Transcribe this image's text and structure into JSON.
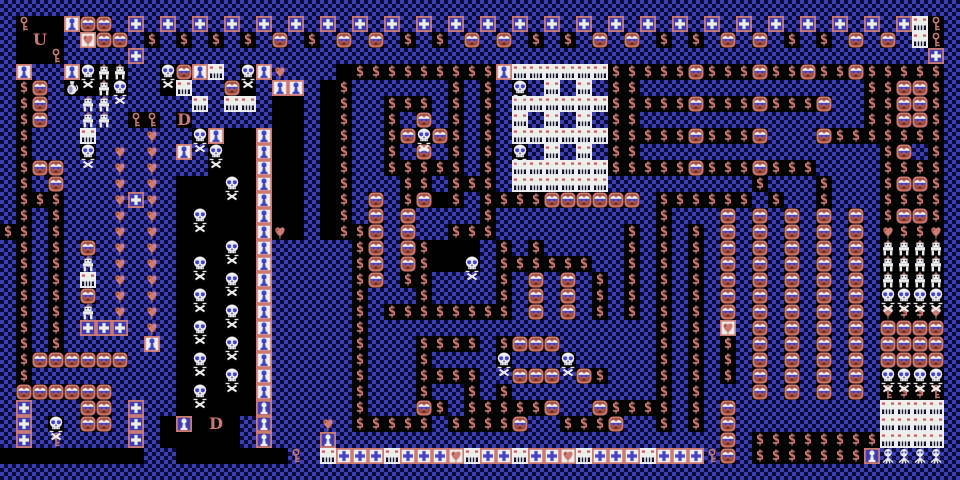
{
  "screen": {
    "title": "CGA dungeon maze level",
    "type": "tile-map-game",
    "width_px": 960,
    "height_px": 480
  },
  "grid": {
    "cols": 60,
    "rows": 30,
    "tile_size_px": 16
  },
  "palette": {
    "floor_blue": "#3d3db5",
    "floor_dot": "#0c0c38",
    "void_black": "#000000",
    "salmon": "#cd7b72",
    "salmon_dark": "#a44c42",
    "white": "#ededed",
    "sprite_blue": "#4444c6",
    "maroon": "#6e241c",
    "mouth_dark": "#181838"
  },
  "legend": {
    ".": {
      "name": "floor",
      "desc": "blue checkered floor"
    },
    "#": {
      "name": "void",
      "desc": "black empty space"
    },
    "$": {
      "name": "treasure",
      "desc": "dollar treasure block",
      "glyph": "$"
    },
    "f": {
      "name": "monster-face",
      "desc": "salmon face monster block"
    },
    "c": {
      "name": "cross-item",
      "desc": "white cross on blue tile"
    },
    "C": {
      "name": "cross-item-light",
      "desc": "blue cross on white tile"
    },
    "m": {
      "name": "block-monster",
      "desc": "white block with red eyes and toothy mouth"
    },
    "s": {
      "name": "skull",
      "desc": "skull with crossbones"
    },
    "n": {
      "name": "gnome-on-void",
      "desc": "small white creature on black"
    },
    "g": {
      "name": "gnome",
      "desc": "small white creature"
    },
    "G": {
      "name": "spider",
      "desc": "white spider creature"
    },
    "h": {
      "name": "heart",
      "desc": "dripping heart on floor"
    },
    "H": {
      "name": "heart-on-white",
      "desc": "dripping heart on white tile"
    },
    "B": {
      "name": "heart-on-void",
      "desc": "dripping heart on black"
    },
    "k": {
      "name": "key-on-void",
      "desc": "salmon key on black"
    },
    "K": {
      "name": "key",
      "desc": "salmon key on floor"
    },
    "t": {
      "name": "statue-white",
      "desc": "blue pawn statue on white tile"
    },
    "T": {
      "name": "statue-blue",
      "desc": "white pawn statue on blue tile"
    },
    "j": {
      "name": "jug",
      "desc": "white jug on black"
    },
    "U": {
      "name": "stairs-up",
      "desc": "letter U staircase up",
      "glyph": "U"
    },
    "D": {
      "name": "stairs-down",
      "desc": "letter D staircase down",
      "glyph": "D"
    }
  },
  "map_rows": [
    "............................................................",
    ".k##tff.c.c.c.c.c.c.c.c.c.c.c.c.c.c.c.c.c.c.c.c.c.c.c.c.cmk.",
    ".#U#.Hff.$.$.$.$.f.$.f.f.$.$.f.f.$.$.f.f.$.$.f.f.$.$.f.f.mk.",
    ".##k....c.................................................c.",
    ".t..tsnn..sftm.sth...#$$$$$$$$$tmmmmmm$$$$$f$$$f$$f$$f$$$$$.",
    ".$f.j#ns..#m..f#.tt.#$......$.$.s.m.m.$$..............$$ff$.",
    ".$f..gg.....m.mm.##.#$..$$$.$.$.mmmmmm$$$$$f$$$f$$$f..$$ff$.",
    ".$f..gg.kk.D.....##.#$..$.f.$.$.m.m.m.$$..............$$ff$.",
    ".$...m...h..st##t##.#$..$fsf$.$.mmmmmm$$$$$f$$$f...f$$$$$$$.",
    ".$...s.h.h.t.s##t##.#$..$.f.$.$.s.m.m.$$...............$f.$.",
    ".$ff...h.h...###t##.#$..$$$$$.$.mmmmmm$$$$$f$$$f$$$....$$$$.",
    ".$.f...h.h.###s#t##.#$...$$.$$$.mmmmmm.........$...$...$ff$.",
    ".$$$...hch.#####t##.#$.f.$f#$.$$$$ffffff.$$$$$$.$..$...$$$$.",
    ".$.$...h.h.#s###t##.#$.f.f....$..........$...f.f.f.f.f.$ff$.",
    "$$.$...h.h.#####tB#.#$$f.f..$$$........$.$.$.f.f.f.f.f.B$$B.",
    ".$.$.f.h.h.###s#t.....$f.f$###.$.$.....$.$.$.f.f.f.f.f.nnnn.",
    ".$.$.g.h.h.#s###t.....$f.f$##s.$$$$$$..$.$.$.f.f.f.f.f.nnnn.",
    ".$.$.m.h.h.###s#t.....$f.$$....$.f.f.$.$.$.$.f.f.f.f.f.nnnn.",
    ".$.$.f.h.h.#s###t.....$...$....$.f.f.$.$.$.$.f.f.f.f.f.ssss.",
    ".$.$.g.h.h.###s#t.....$.$$$$$$$$.f.f.$.$.$.$.f.f.f.f.f.B$$B.",
    ".$.$.ccc.h.#s###t.....$..................$.$.H.f.f.f.f.ffff.",
    ".$.$.....t.###s#t.....$...$$$$.$fff......$.$.$.f.f.f.f.ffff.",
    ".$ffffff...#s###t.....$...$....s...s.....$.$.$.f.f.f.f.ffff.",
    ".$.........###s#t.....$...$$$$..fff.f$...$.$.$.f.f.f.f.ssss.",
    ".ffffff....#s###t.....$...$..$.$.........$.$...f.f.f.f.k$$k.",
    ".c...ff.c..#####T.....$...f$.$$$$$f..f$$$$.$.f.........mmmm.",
    ".c.s.ff.c.#T#D#.T...h.$$$$$.$$$$f..$$$f..$.$.f.........mmmm.",
    ".c.K....c.#####.T...T........................f.$$$$$$$$mmmm.",
    "#########..#######K.mCCCmCCCHmCCmCCHmCCCmCCCKf.$$$$$$$TGGGG.",
    "............................................................"
  ]
}
